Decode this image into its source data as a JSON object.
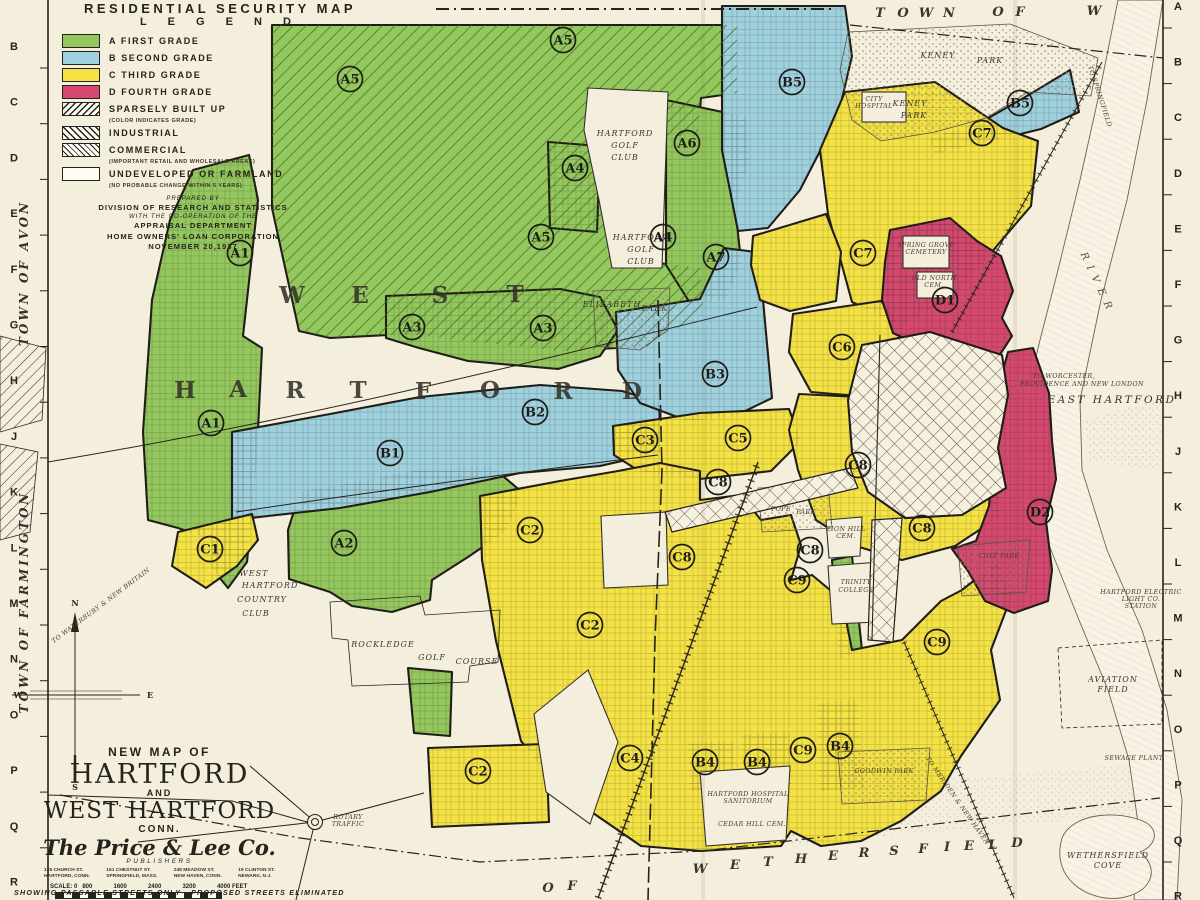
{
  "header": {
    "series_title": "RESIDENTIAL SECURITY MAP"
  },
  "legend": {
    "title": "L E G E N D",
    "entries": [
      {
        "swatch": "green",
        "label": "A  FIRST GRADE",
        "note": ""
      },
      {
        "swatch": "blue",
        "label": "B  SECOND GRADE",
        "note": ""
      },
      {
        "swatch": "yellow",
        "label": "C  THIRD GRADE",
        "note": ""
      },
      {
        "swatch": "red",
        "label": "D  FOURTH GRADE",
        "note": ""
      },
      {
        "swatch": "hatch",
        "label": "SPARSELY BUILT UP",
        "note": "(COLOR INDICATES GRADE)"
      },
      {
        "swatch": "ind",
        "label": "INDUSTRIAL",
        "note": ""
      },
      {
        "swatch": "com",
        "label": "COMMERCIAL",
        "note": "(IMPORTANT RETAIL AND WHOLESALE AREAS)"
      },
      {
        "swatch": "white",
        "label": "UNDEVELOPED OR FARMLAND",
        "note": "(NO PROBABLE CHANGE WITHIN 5 YEARS)"
      }
    ],
    "prepared_by": [
      {
        "style": "p-it",
        "text": "PREPARED BY"
      },
      {
        "style": "p-b",
        "text": "DIVISION OF RESEARCH AND STATISTICS"
      },
      {
        "style": "p-it",
        "text": "WITH THE CO-OPERATION OF THE"
      },
      {
        "style": "p-b",
        "text": "APPRAISAL DEPARTMENT"
      },
      {
        "style": "p-b",
        "text": "HOME OWNERS' LOAN CORPORATION"
      },
      {
        "style": "p-b",
        "text": "NOVEMBER 20,1937"
      }
    ]
  },
  "title_block": {
    "line1": "NEW MAP OF",
    "city1": "HARTFORD",
    "and": "AND",
    "city2": "WEST HARTFORD",
    "state": "CONN.",
    "publisher": "The Price & Lee Co.",
    "publisher_sub": "PUBLISHERS",
    "addresses": [
      "185 CHURCH ST.\nHARTFORD, CONN.",
      "151 CHESTNUT ST.\nSPRINGFIELD, MASS.",
      "248 MEADOW ST.\nNEW HAVEN, CONN.",
      "19 CLINTON ST.\nNEWARK, N.J."
    ],
    "scale_label": "SCALE: 0",
    "scale_ticks": [
      "800",
      "1600",
      "2400",
      "3200",
      "4000 FEET"
    ],
    "transport_bus": "Transportation by Bus or Trolley",
    "transport_rail": "Steam Railroad",
    "footnote": "SHOWING PASSABLE STREETS ONLY - PROPOSED STREETS ELIMINATED"
  },
  "map": {
    "colors": {
      "grade_a": "#94c75e",
      "grade_b": "#9fd1df",
      "grade_c": "#f5e345",
      "grade_d": "#d5486f",
      "paper": "#f4eedd",
      "ink": "#26231d"
    },
    "grid_letters_left": [
      "B",
      "C",
      "D",
      "E",
      "F",
      "G",
      "H",
      "J",
      "K",
      "L",
      "M",
      "N",
      "O",
      "P",
      "Q",
      "R"
    ],
    "grid_letters_right": [
      "A",
      "B",
      "C",
      "D",
      "E",
      "F",
      "G",
      "H",
      "J",
      "K",
      "L",
      "M",
      "N",
      "O",
      "P",
      "Q",
      "R"
    ],
    "zone_markers": [
      {
        "id": "A1",
        "x": 240,
        "y": 253
      },
      {
        "id": "A1",
        "x": 211,
        "y": 423
      },
      {
        "id": "A2",
        "x": 344,
        "y": 543
      },
      {
        "id": "A3",
        "x": 412,
        "y": 327
      },
      {
        "id": "A3",
        "x": 543,
        "y": 328
      },
      {
        "id": "A4",
        "x": 575,
        "y": 168
      },
      {
        "id": "A4",
        "x": 663,
        "y": 237
      },
      {
        "id": "A5",
        "x": 350,
        "y": 79
      },
      {
        "id": "A5",
        "x": 563,
        "y": 40
      },
      {
        "id": "A5",
        "x": 541,
        "y": 237
      },
      {
        "id": "A6",
        "x": 687,
        "y": 143
      },
      {
        "id": "A7",
        "x": 716,
        "y": 257
      },
      {
        "id": "B1",
        "x": 390,
        "y": 453
      },
      {
        "id": "B2",
        "x": 535,
        "y": 412
      },
      {
        "id": "B3",
        "x": 715,
        "y": 374
      },
      {
        "id": "B4",
        "x": 705,
        "y": 762
      },
      {
        "id": "B4",
        "x": 757,
        "y": 762
      },
      {
        "id": "B4",
        "x": 840,
        "y": 746
      },
      {
        "id": "B5",
        "x": 792,
        "y": 82
      },
      {
        "id": "B5",
        "x": 1020,
        "y": 103
      },
      {
        "id": "C1",
        "x": 210,
        "y": 549
      },
      {
        "id": "C2",
        "x": 530,
        "y": 530
      },
      {
        "id": "C2",
        "x": 590,
        "y": 625
      },
      {
        "id": "C2",
        "x": 478,
        "y": 771
      },
      {
        "id": "C3",
        "x": 645,
        "y": 440
      },
      {
        "id": "C4",
        "x": 630,
        "y": 758
      },
      {
        "id": "C5",
        "x": 738,
        "y": 438
      },
      {
        "id": "C6",
        "x": 842,
        "y": 347
      },
      {
        "id": "C7",
        "x": 982,
        "y": 133
      },
      {
        "id": "C7",
        "x": 863,
        "y": 253
      },
      {
        "id": "C8",
        "x": 718,
        "y": 482
      },
      {
        "id": "C8",
        "x": 858,
        "y": 465
      },
      {
        "id": "C8",
        "x": 922,
        "y": 528
      },
      {
        "id": "C8",
        "x": 682,
        "y": 557
      },
      {
        "id": "C8",
        "x": 810,
        "y": 550
      },
      {
        "id": "C9",
        "x": 797,
        "y": 580
      },
      {
        "id": "C9",
        "x": 937,
        "y": 642
      },
      {
        "id": "C9",
        "x": 803,
        "y": 750
      },
      {
        "id": "D1",
        "x": 945,
        "y": 300
      },
      {
        "id": "D2",
        "x": 1040,
        "y": 512
      }
    ],
    "labels": [
      {
        "t": "W",
        "x": 292,
        "y": 303,
        "c": "sp"
      },
      {
        "t": "E",
        "x": 360,
        "y": 303,
        "c": "sp"
      },
      {
        "t": "S",
        "x": 440,
        "y": 303,
        "c": "sp"
      },
      {
        "t": "T",
        "x": 515,
        "y": 302,
        "c": "sp"
      },
      {
        "t": "H",
        "x": 185,
        "y": 398,
        "c": "sp"
      },
      {
        "t": "A",
        "x": 238,
        "y": 397,
        "c": "sp"
      },
      {
        "t": "R",
        "x": 295,
        "y": 398,
        "c": "sp"
      },
      {
        "t": "T",
        "x": 358,
        "y": 398,
        "c": "sp"
      },
      {
        "t": "F",
        "x": 423,
        "y": 399,
        "c": "sp"
      },
      {
        "t": "O",
        "x": 490,
        "y": 398,
        "c": "sp"
      },
      {
        "t": "R",
        "x": 563,
        "y": 399,
        "c": "sp"
      },
      {
        "t": "D",
        "x": 632,
        "y": 399,
        "c": "sp"
      },
      {
        "t": "T",
        "x": 880,
        "y": 17,
        "c": "sp2"
      },
      {
        "t": "O",
        "x": 903,
        "y": 17,
        "c": "sp2"
      },
      {
        "t": "W",
        "x": 926,
        "y": 17,
        "c": "sp2"
      },
      {
        "t": "N",
        "x": 949,
        "y": 17,
        "c": "sp2"
      },
      {
        "t": "O",
        "x": 998,
        "y": 16,
        "c": "sp2"
      },
      {
        "t": "F",
        "x": 1020,
        "y": 16,
        "c": "sp2"
      },
      {
        "t": "W",
        "x": 1094,
        "y": 15,
        "c": "sp2"
      },
      {
        "t": "O",
        "x": 548,
        "y": 892,
        "c": "sp2"
      },
      {
        "t": "F",
        "x": 572,
        "y": 890,
        "c": "sp2"
      },
      {
        "t": "W",
        "x": 700,
        "y": 873,
        "c": "sp2"
      },
      {
        "t": "E",
        "x": 735,
        "y": 869,
        "c": "sp2"
      },
      {
        "t": "T",
        "x": 768,
        "y": 866,
        "c": "sp2"
      },
      {
        "t": "H",
        "x": 801,
        "y": 863,
        "c": "sp2"
      },
      {
        "t": "E",
        "x": 833,
        "y": 860,
        "c": "sp2"
      },
      {
        "t": "R",
        "x": 864,
        "y": 857,
        "c": "sp2"
      },
      {
        "t": "S",
        "x": 894,
        "y": 855,
        "c": "sp2"
      },
      {
        "t": "F",
        "x": 923,
        "y": 853,
        "c": "sp2"
      },
      {
        "t": "I",
        "x": 947,
        "y": 851,
        "c": "sp2"
      },
      {
        "t": "E",
        "x": 969,
        "y": 850,
        "c": "sp2"
      },
      {
        "t": "L",
        "x": 993,
        "y": 849,
        "c": "sp2"
      },
      {
        "t": "D",
        "x": 1017,
        "y": 847,
        "c": "sp2"
      },
      {
        "t": "TOWN OF AVON",
        "x": 28,
        "y": 273,
        "c": "edge",
        "r": -90
      },
      {
        "t": "TOWN OF FARMINGTON",
        "x": 28,
        "y": 602,
        "c": "edge",
        "r": -90
      },
      {
        "t": "RIVER",
        "x": 1095,
        "y": 285,
        "c": "riv",
        "r": 65
      },
      {
        "t": "HARTFORD",
        "x": 625,
        "y": 136,
        "c": "pl"
      },
      {
        "t": "GOLF",
        "x": 625,
        "y": 148,
        "c": "pl"
      },
      {
        "t": "CLUB",
        "x": 625,
        "y": 160,
        "c": "pl"
      },
      {
        "t": "HARTFORD",
        "x": 641,
        "y": 240,
        "c": "pl"
      },
      {
        "t": "GOLF",
        "x": 641,
        "y": 252,
        "c": "pl"
      },
      {
        "t": "CLUB",
        "x": 641,
        "y": 264,
        "c": "pl"
      },
      {
        "t": "ELIZABETH",
        "x": 612,
        "y": 307,
        "c": "pl"
      },
      {
        "t": "PARK",
        "x": 655,
        "y": 311,
        "c": "pl"
      },
      {
        "t": "KENEY",
        "x": 938,
        "y": 58,
        "c": "pl"
      },
      {
        "t": "PARK",
        "x": 990,
        "y": 63,
        "c": "pl"
      },
      {
        "t": "KENEY",
        "x": 910,
        "y": 106,
        "c": "pl"
      },
      {
        "t": "PARK",
        "x": 914,
        "y": 118,
        "c": "pl"
      },
      {
        "t": "WEST",
        "x": 254,
        "y": 576,
        "c": "pl"
      },
      {
        "t": "HARTFORD",
        "x": 270,
        "y": 588,
        "c": "pl"
      },
      {
        "t": "COUNTRY",
        "x": 262,
        "y": 602,
        "c": "pl"
      },
      {
        "t": "CLUB",
        "x": 256,
        "y": 616,
        "c": "pl"
      },
      {
        "t": "ROCKLEDGE",
        "x": 383,
        "y": 647,
        "c": "pl"
      },
      {
        "t": "GOLF",
        "x": 432,
        "y": 660,
        "c": "pl"
      },
      {
        "t": "COURSE",
        "x": 477,
        "y": 664,
        "c": "pl"
      },
      {
        "t": "EAST   HARTFORD",
        "x": 1112,
        "y": 403,
        "c": "pl9"
      },
      {
        "t": "AVIATION",
        "x": 1113,
        "y": 682,
        "c": "pl"
      },
      {
        "t": "FIELD",
        "x": 1113,
        "y": 692,
        "c": "pl"
      },
      {
        "t": "WETHERSFIELD",
        "x": 1108,
        "y": 858,
        "c": "pl"
      },
      {
        "t": "COVE",
        "x": 1108,
        "y": 868,
        "c": "pl"
      },
      {
        "t": "CITY",
        "x": 874,
        "y": 101,
        "c": "tiny"
      },
      {
        "t": "HOSPITAL",
        "x": 874,
        "y": 108,
        "c": "tiny"
      },
      {
        "t": "SPRING GROVE",
        "x": 926,
        "y": 247,
        "c": "tiny"
      },
      {
        "t": "CEMETERY",
        "x": 926,
        "y": 254,
        "c": "tiny"
      },
      {
        "t": "OLD NORTH",
        "x": 934,
        "y": 280,
        "c": "tiny"
      },
      {
        "t": "CEM.",
        "x": 934,
        "y": 287,
        "c": "tiny"
      },
      {
        "t": "POPE",
        "x": 781,
        "y": 511,
        "c": "tiny"
      },
      {
        "t": "PARK",
        "x": 806,
        "y": 514,
        "c": "tiny"
      },
      {
        "t": "ZION HILL",
        "x": 846,
        "y": 531,
        "c": "tiny"
      },
      {
        "t": "CEM.",
        "x": 846,
        "y": 538,
        "c": "tiny"
      },
      {
        "t": "TRINITY",
        "x": 856,
        "y": 584,
        "c": "tiny"
      },
      {
        "t": "COLLEGE",
        "x": 856,
        "y": 592,
        "c": "tiny"
      },
      {
        "t": "COLT  PARK",
        "x": 999,
        "y": 558,
        "c": "tiny"
      },
      {
        "t": "GOODWIN PARK",
        "x": 884,
        "y": 773,
        "c": "tiny"
      },
      {
        "t": "HARTFORD HOSPITAL",
        "x": 748,
        "y": 796,
        "c": "tiny"
      },
      {
        "t": "SANITORIUM",
        "x": 748,
        "y": 803,
        "c": "tiny"
      },
      {
        "t": "CEDAR HILL CEM.",
        "x": 752,
        "y": 826,
        "c": "tiny"
      },
      {
        "t": "SEWAGE PLANT",
        "x": 1134,
        "y": 760,
        "c": "tiny"
      },
      {
        "t": "HARTFORD ELECTRIC",
        "x": 1141,
        "y": 594,
        "c": "tiny"
      },
      {
        "t": "LIGHT CO.",
        "x": 1141,
        "y": 601,
        "c": "tiny"
      },
      {
        "t": "STATION",
        "x": 1141,
        "y": 608,
        "c": "tiny"
      },
      {
        "t": "TO WORCESTER,",
        "x": 1064,
        "y": 378,
        "c": "tiny"
      },
      {
        "t": "PROVIDENCE AND NEW LONDON",
        "x": 1082,
        "y": 386,
        "c": "tiny"
      },
      {
        "t": "ROTARY",
        "x": 348,
        "y": 819,
        "c": "tiny"
      },
      {
        "t": "TRAFFIC",
        "x": 348,
        "y": 826,
        "c": "tiny"
      },
      {
        "t": "TO SPRINGFIELD",
        "x": 1098,
        "y": 97,
        "c": "tiny",
        "r": 72
      },
      {
        "t": "TO MERIDEN & NEW HAVEN",
        "x": 956,
        "y": 802,
        "c": "tiny",
        "r": 55
      },
      {
        "t": "TO WATERBURY & NEW BRITAIN",
        "x": 102,
        "y": 607,
        "c": "tiny",
        "r": -37
      },
      {
        "t": "N",
        "x": 75,
        "y": 606,
        "c": "cmp"
      },
      {
        "t": "W",
        "x": 18,
        "y": 698,
        "c": "cmp"
      },
      {
        "t": "E",
        "x": 150,
        "y": 698,
        "c": "cmp"
      },
      {
        "t": "S",
        "x": 75,
        "y": 790,
        "c": "cmp"
      }
    ]
  }
}
